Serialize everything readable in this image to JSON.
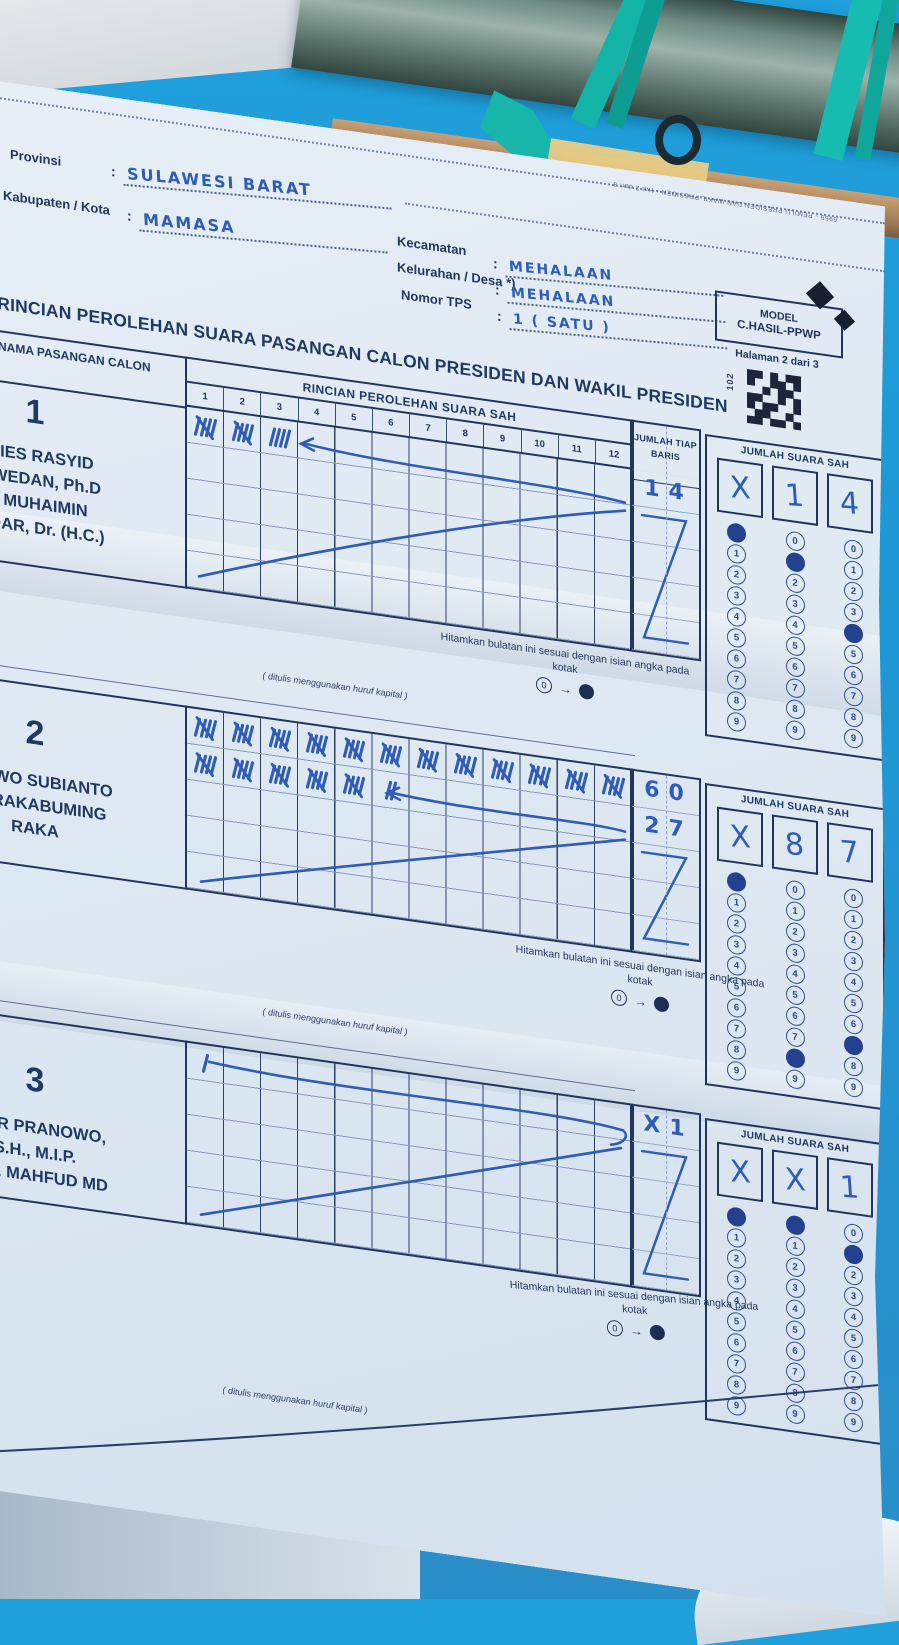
{
  "photo": {
    "sky_color": "#1f9fda",
    "pipe_color": "#5f7a76",
    "strap_color": "#14b4a9",
    "wood_color": "#b88a60",
    "paper_color": "#dde8f2",
    "print_ink_color": "#1f3357",
    "pen_ink_color": "#2e5cb8"
  },
  "edge_print": "6959 - PEMILU PRESIDEN DAN WAKIL PRESIDEN - Hal 2 dari 3",
  "header": {
    "fields_left": [
      {
        "label": "Provinsi",
        "colon": ":",
        "value": "SULAWESI  BARAT"
      },
      {
        "label": "Kabupaten / Kota",
        "colon": ":",
        "value": "MAMASA"
      }
    ],
    "fields_right": [
      {
        "label": "Kecamatan",
        "colon": ":",
        "value": "MEHALAAN"
      },
      {
        "label": "Kelurahan / Desa *)",
        "colon": ":",
        "value": "MEHALAAN"
      },
      {
        "label": "Nomor TPS",
        "colon": ":",
        "value": "1   ( SATU )"
      }
    ],
    "model_box": {
      "line1": "MODEL",
      "line2": "C.HASIL-PPWP",
      "page": "Halaman 2 dari 3",
      "code": "102"
    }
  },
  "title": "A RINCIAN PEROLEHAN SUARA PASANGAN CALON PRESIDEN DAN WAKIL PRESIDEN",
  "table": {
    "col_header": "NOMOR DAN NAMA PASANGAN CALON",
    "grid_header": "RINCIAN PEROLEHAN SUARA SAH",
    "grid_columns": [
      "1",
      "2",
      "3",
      "4",
      "5",
      "6",
      "7",
      "8",
      "9",
      "10",
      "11",
      "12"
    ],
    "row_total_header": "JUMLAH TIAP BARIS",
    "valid_votes_header": "JUMLAH SUARA SAH",
    "hint": "Hitamkan bulatan ini sesuai dengan isian angka pada kotak",
    "hint_demo": {
      "zero": "0",
      "arrow": "→"
    },
    "caps_note": "( ditulis menggunakan huruf kapital )",
    "bubble_digits": [
      "0",
      "1",
      "2",
      "3",
      "4",
      "5",
      "6",
      "7",
      "8",
      "9"
    ]
  },
  "candidates": [
    {
      "number": "1",
      "name_text": "ANIES RASYID\nASWEDAN, Ph.D\nA. MUHAIMIN\nANDAR, Dr. (H.C.)",
      "tally_rows": [
        [
          5,
          5,
          4
        ],
        [],
        [],
        [],
        []
      ],
      "row_totals": [
        "14",
        "",
        "",
        "",
        ""
      ],
      "digit_boxes": [
        "X",
        "1",
        "4"
      ],
      "filled_bubbles": [
        0,
        1,
        4
      ]
    },
    {
      "number": "2",
      "name_text": "ABOWO SUBIANTO\nAN RAKABUMING\nRAKA",
      "tally_rows": [
        [
          5,
          5,
          5,
          5,
          5,
          5,
          5,
          5,
          5,
          5,
          5,
          5
        ],
        [
          5,
          5,
          5,
          5,
          5,
          2
        ],
        [],
        [],
        []
      ],
      "row_totals": [
        "60",
        "27",
        "",
        "",
        ""
      ],
      "digit_boxes": [
        "X",
        "8",
        "7"
      ],
      "filled_bubbles": [
        0,
        8,
        7
      ]
    },
    {
      "number": "3",
      "name_text": "NJAR PRANOWO,\nS.H., M.I.P.\nH. M. MAHFUD MD",
      "tally_rows": [
        [
          1
        ],
        [],
        [],
        [],
        []
      ],
      "row_totals": [
        "X1",
        "",
        "",
        "",
        ""
      ],
      "digit_boxes": [
        "X",
        "X",
        "1"
      ],
      "filled_bubbles": [
        0,
        0,
        1
      ]
    }
  ]
}
